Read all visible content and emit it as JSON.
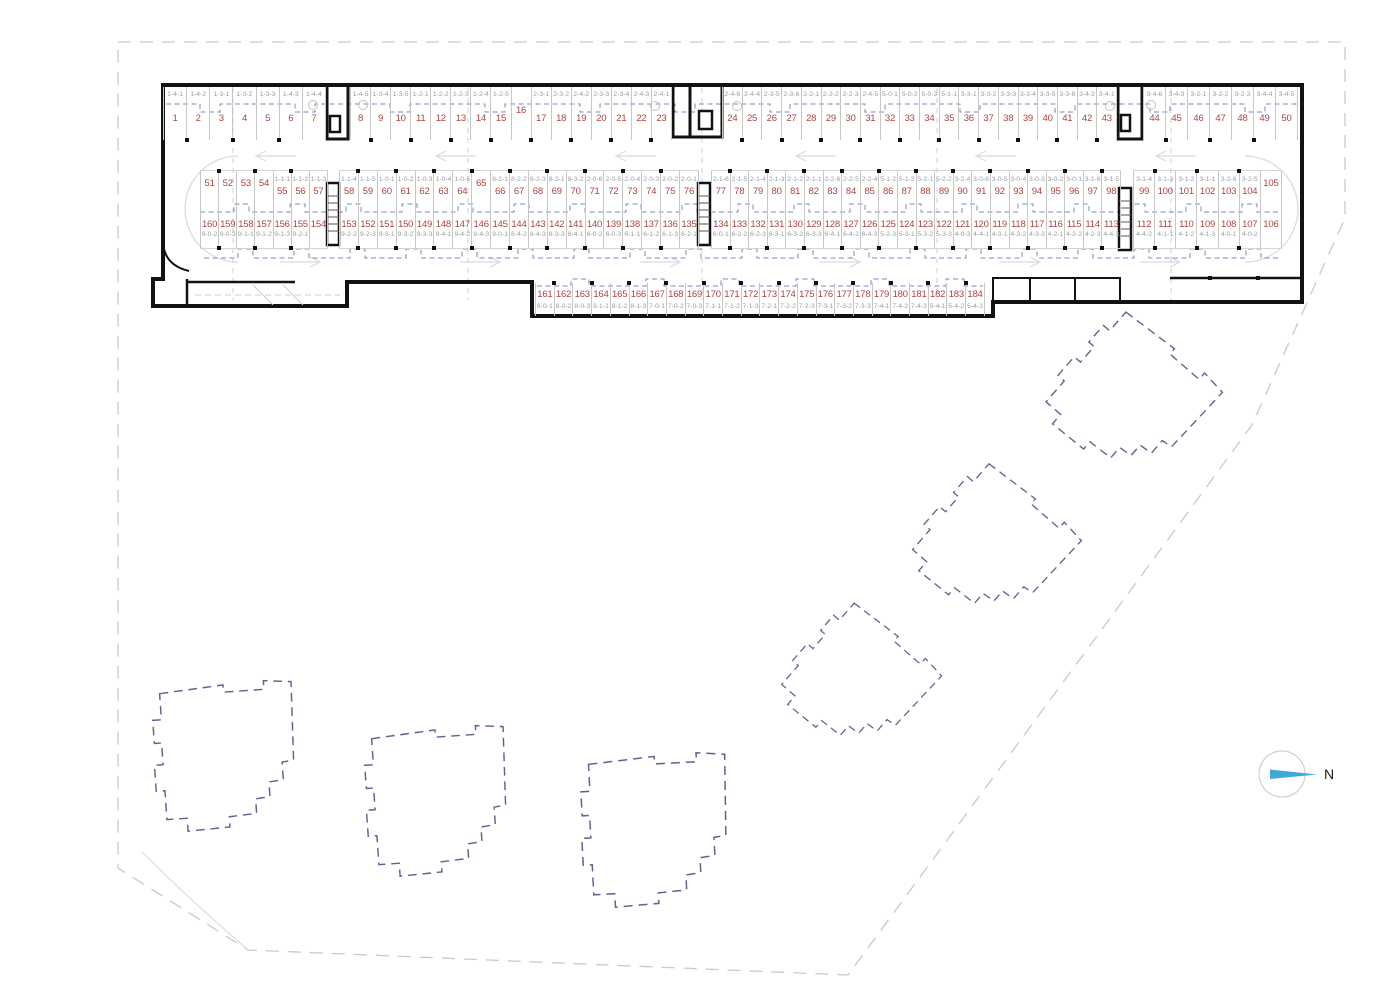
{
  "plan": {
    "north_label": "N",
    "colors": {
      "space_number": "#ac4340",
      "unit_label": "#9c9c9c",
      "building_outline": "#5d6390",
      "north_arrow_blue": "#3fa9dc",
      "walls": "#121212"
    },
    "rows": [
      {
        "id": "top",
        "y": 87,
        "h": 53,
        "label_first": true,
        "tick_side": "bottom",
        "segments": [
          {
            "x": 163,
            "w": 163,
            "spaces": [
              {
                "no": "1",
                "unit": "1-4-1"
              },
              {
                "no": "2",
                "unit": "1-4-2"
              },
              {
                "no": "3",
                "unit": "1-3-1"
              },
              {
                "no": "4",
                "unit": "1-3-2"
              },
              {
                "no": "5",
                "unit": "1-3-3"
              },
              {
                "no": "6",
                "unit": "1-4-3"
              },
              {
                "no": "7",
                "unit": "1-4-4"
              }
            ]
          },
          {
            "x": 350,
            "w": 322,
            "spaces": [
              {
                "no": "8",
                "unit": "1-4-5"
              },
              {
                "no": "9",
                "unit": "1-3-4"
              },
              {
                "no": "10",
                "unit": "1-3-5"
              },
              {
                "no": "11",
                "unit": "1-2-1"
              },
              {
                "no": "12",
                "unit": "1-2-2"
              },
              {
                "no": "13",
                "unit": "1-2-3"
              },
              {
                "no": "14",
                "unit": "1-2-4"
              },
              {
                "no": "15",
                "unit": "1-2-5"
              },
              {
                "no": "16",
                "unit": ""
              },
              {
                "no": "17",
                "unit": "2-3-1"
              },
              {
                "no": "18",
                "unit": "2-3-2"
              },
              {
                "no": "19",
                "unit": "2-4-2"
              },
              {
                "no": "20",
                "unit": "2-3-3"
              },
              {
                "no": "21",
                "unit": "2-3-4"
              },
              {
                "no": "22",
                "unit": "2-4-3"
              },
              {
                "no": "23",
                "unit": "2-4-1"
              }
            ]
          },
          {
            "x": 722,
            "w": 395,
            "spaces": [
              {
                "no": "24",
                "unit": "2-4-6"
              },
              {
                "no": "25",
                "unit": "2-4-4"
              },
              {
                "no": "26",
                "unit": "2-3-5"
              },
              {
                "no": "27",
                "unit": "2-3-6"
              },
              {
                "no": "28",
                "unit": "2-2-1"
              },
              {
                "no": "29",
                "unit": "2-2-2"
              },
              {
                "no": "30",
                "unit": "2-2-3"
              },
              {
                "no": "31",
                "unit": "2-4-5"
              },
              {
                "no": "32",
                "unit": "5-0-1"
              },
              {
                "no": "33",
                "unit": "5-0-2"
              },
              {
                "no": "34",
                "unit": "5-0-3"
              },
              {
                "no": "35",
                "unit": "5-1-1"
              },
              {
                "no": "36",
                "unit": "3-3-1"
              },
              {
                "no": "37",
                "unit": "3-3-2"
              },
              {
                "no": "38",
                "unit": "3-3-3"
              },
              {
                "no": "39",
                "unit": "3-3-4"
              },
              {
                "no": "40",
                "unit": "3-3-5"
              },
              {
                "no": "41",
                "unit": "3-3-6"
              },
              {
                "no": "42",
                "unit": "3-4-2"
              },
              {
                "no": "43",
                "unit": "3-4-1"
              }
            ]
          },
          {
            "x": 1143,
            "w": 155,
            "spaces": [
              {
                "no": "44",
                "unit": "3-4-6"
              },
              {
                "no": "45",
                "unit": "3-4-3"
              },
              {
                "no": "46",
                "unit": "3-2-1"
              },
              {
                "no": "47",
                "unit": "3-2-2"
              },
              {
                "no": "48",
                "unit": "3-2-3"
              },
              {
                "no": "49",
                "unit": "3-4-4"
              },
              {
                "no": "50",
                "unit": "3-4-5"
              }
            ]
          }
        ]
      },
      {
        "id": "midup",
        "y": 170,
        "h": 42,
        "label_first": true,
        "tick_side": "top",
        "segments": [
          {
            "x": 200,
            "w": 128,
            "spaces": [
              {
                "no": "51",
                "unit": ""
              },
              {
                "no": "52",
                "unit": ""
              },
              {
                "no": "53",
                "unit": ""
              },
              {
                "no": "54",
                "unit": ""
              },
              {
                "no": "55",
                "unit": "1-1-1"
              },
              {
                "no": "56",
                "unit": "1-1-2"
              },
              {
                "no": "57",
                "unit": "1-1-3"
              }
            ]
          },
          {
            "x": 339,
            "w": 360,
            "spaces": [
              {
                "no": "58",
                "unit": "1-1-4"
              },
              {
                "no": "59",
                "unit": "1-1-5"
              },
              {
                "no": "60",
                "unit": "1-0-1"
              },
              {
                "no": "61",
                "unit": "1-0-2"
              },
              {
                "no": "62",
                "unit": "1-0-3"
              },
              {
                "no": "63",
                "unit": "1-0-4"
              },
              {
                "no": "64",
                "unit": "1-0-5"
              },
              {
                "no": "65",
                "unit": ""
              },
              {
                "no": "66",
                "unit": "8-2-1"
              },
              {
                "no": "67",
                "unit": "8-2-2"
              },
              {
                "no": "68",
                "unit": "8-2-3"
              },
              {
                "no": "69",
                "unit": "8-3-1"
              },
              {
                "no": "70",
                "unit": "8-3-2"
              },
              {
                "no": "71",
                "unit": "2-0-6"
              },
              {
                "no": "72",
                "unit": "2-0-5"
              },
              {
                "no": "73",
                "unit": "2-0-4"
              },
              {
                "no": "74",
                "unit": "2-0-3"
              },
              {
                "no": "75",
                "unit": "2-0-2"
              },
              {
                "no": "76",
                "unit": "2-0-1"
              }
            ]
          },
          {
            "x": 711,
            "w": 410,
            "spaces": [
              {
                "no": "77",
                "unit": "2-1-6"
              },
              {
                "no": "78",
                "unit": "2-1-5"
              },
              {
                "no": "79",
                "unit": "2-1-4"
              },
              {
                "no": "80",
                "unit": "2-1-3"
              },
              {
                "no": "81",
                "unit": "2-1-2"
              },
              {
                "no": "82",
                "unit": "2-1-1"
              },
              {
                "no": "83",
                "unit": "2-2-6"
              },
              {
                "no": "84",
                "unit": "2-2-5"
              },
              {
                "no": "85",
                "unit": "2-2-4"
              },
              {
                "no": "86",
                "unit": "5-1-2"
              },
              {
                "no": "87",
                "unit": "5-1-3"
              },
              {
                "no": "88",
                "unit": "5-2-1"
              },
              {
                "no": "89",
                "unit": "5-2-2"
              },
              {
                "no": "90",
                "unit": "3-2-4"
              },
              {
                "no": "91",
                "unit": "3-0-6"
              },
              {
                "no": "92",
                "unit": "3-0-5"
              },
              {
                "no": "93",
                "unit": "3-0-4"
              },
              {
                "no": "94",
                "unit": "3-0-3"
              },
              {
                "no": "95",
                "unit": "3-0-2"
              },
              {
                "no": "96",
                "unit": "3-0-1"
              },
              {
                "no": "97",
                "unit": "3-1-6"
              },
              {
                "no": "98",
                "unit": "3-1-5"
              }
            ]
          },
          {
            "x": 1133,
            "w": 149,
            "spaces": [
              {
                "no": "99",
                "unit": "3-1-4"
              },
              {
                "no": "100",
                "unit": "3-1-3"
              },
              {
                "no": "101",
                "unit": "3-1-2"
              },
              {
                "no": "102",
                "unit": "3-1-1"
              },
              {
                "no": "103",
                "unit": "3-2-6"
              },
              {
                "no": "104",
                "unit": "3-2-5"
              },
              {
                "no": "105",
                "unit": ""
              }
            ]
          }
        ]
      },
      {
        "id": "middown",
        "y": 212,
        "h": 36,
        "label_first": false,
        "tick_side": "bottom",
        "segments": [
          {
            "x": 200,
            "w": 128,
            "spaces": [
              {
                "no": "160",
                "unit": "9-0-2"
              },
              {
                "no": "159",
                "unit": "9-0-3"
              },
              {
                "no": "158",
                "unit": "9-1-1"
              },
              {
                "no": "157",
                "unit": "9-1-2"
              },
              {
                "no": "156",
                "unit": "9-1-3"
              },
              {
                "no": "155",
                "unit": "9-2-1"
              },
              {
                "no": "154",
                "unit": ""
              }
            ]
          },
          {
            "x": 339,
            "w": 360,
            "spaces": [
              {
                "no": "153",
                "unit": "9-2-2"
              },
              {
                "no": "152",
                "unit": "9-2-3"
              },
              {
                "no": "151",
                "unit": "9-3-1"
              },
              {
                "no": "150",
                "unit": "9-3-2"
              },
              {
                "no": "149",
                "unit": "9-3-3"
              },
              {
                "no": "148",
                "unit": "9-4-1"
              },
              {
                "no": "147",
                "unit": "9-4-2"
              },
              {
                "no": "146",
                "unit": "9-4-3"
              },
              {
                "no": "145",
                "unit": "9-0-1"
              },
              {
                "no": "144",
                "unit": "8-4-2"
              },
              {
                "no": "143",
                "unit": "8-4-3"
              },
              {
                "no": "142",
                "unit": "8-3-3"
              },
              {
                "no": "141",
                "unit": "8-4-1"
              },
              {
                "no": "140",
                "unit": "6-0-2"
              },
              {
                "no": "139",
                "unit": "6-0-3"
              },
              {
                "no": "138",
                "unit": "6-1-1"
              },
              {
                "no": "137",
                "unit": "6-1-2"
              },
              {
                "no": "136",
                "unit": "6-1-3"
              },
              {
                "no": "135",
                "unit": "6-2-1"
              }
            ]
          },
          {
            "x": 711,
            "w": 410,
            "spaces": [
              {
                "no": "134",
                "unit": "6-0-1"
              },
              {
                "no": "133",
                "unit": "6-2-2"
              },
              {
                "no": "132",
                "unit": "6-2-3"
              },
              {
                "no": "131",
                "unit": "6-3-1"
              },
              {
                "no": "130",
                "unit": "6-3-2"
              },
              {
                "no": "129",
                "unit": "6-3-3"
              },
              {
                "no": "128",
                "unit": "6-4-1"
              },
              {
                "no": "127",
                "unit": "6-4-2"
              },
              {
                "no": "126",
                "unit": "6-4-3"
              },
              {
                "no": "125",
                "unit": "5-2-3"
              },
              {
                "no": "124",
                "unit": "5-3-1"
              },
              {
                "no": "123",
                "unit": "5-3-2"
              },
              {
                "no": "122",
                "unit": "5-3-3"
              },
              {
                "no": "121",
                "unit": "4-0-3"
              },
              {
                "no": "120",
                "unit": "4-4-1"
              },
              {
                "no": "119",
                "unit": "4-3-1"
              },
              {
                "no": "118",
                "unit": "4-3-2"
              },
              {
                "no": "117",
                "unit": "4-3-3"
              },
              {
                "no": "116",
                "unit": "4-2-1"
              },
              {
                "no": "115",
                "unit": "4-2-2"
              },
              {
                "no": "114",
                "unit": "4-2-3"
              },
              {
                "no": "113",
                "unit": "4-4-3"
              }
            ]
          },
          {
            "x": 1133,
            "w": 149,
            "spaces": [
              {
                "no": "112",
                "unit": "4-4-2"
              },
              {
                "no": "111",
                "unit": "4-1-1"
              },
              {
                "no": "110",
                "unit": "4-1-2"
              },
              {
                "no": "109",
                "unit": "4-1-3"
              },
              {
                "no": "108",
                "unit": "4-0-1"
              },
              {
                "no": "107",
                "unit": "4-0-2"
              },
              {
                "no": "106",
                "unit": ""
              }
            ]
          }
        ]
      },
      {
        "id": "bottomrow",
        "y": 283,
        "h": 33,
        "label_first": false,
        "tick_side": "top",
        "segments": [
          {
            "x": 535,
            "w": 450,
            "spaces": [
              {
                "no": "161",
                "unit": "8-0-1"
              },
              {
                "no": "162",
                "unit": "8-0-2"
              },
              {
                "no": "163",
                "unit": "8-0-3"
              },
              {
                "no": "164",
                "unit": "8-1-1"
              },
              {
                "no": "165",
                "unit": "8-1-2"
              },
              {
                "no": "166",
                "unit": "8-1-3"
              },
              {
                "no": "167",
                "unit": "7-0-1"
              },
              {
                "no": "168",
                "unit": "7-0-2"
              },
              {
                "no": "169",
                "unit": "7-0-3"
              },
              {
                "no": "170",
                "unit": "7-1-1"
              },
              {
                "no": "171",
                "unit": "7-1-2"
              },
              {
                "no": "172",
                "unit": "7-1-3"
              },
              {
                "no": "173",
                "unit": "7-2-1"
              },
              {
                "no": "174",
                "unit": "7-2-2"
              },
              {
                "no": "175",
                "unit": "7-2-3"
              },
              {
                "no": "176",
                "unit": "7-3-1"
              },
              {
                "no": "177",
                "unit": "7-3-2"
              },
              {
                "no": "178",
                "unit": "7-3-3"
              },
              {
                "no": "179",
                "unit": "7-4-1"
              },
              {
                "no": "180",
                "unit": "7-4-2"
              },
              {
                "no": "181",
                "unit": "7-4-3"
              },
              {
                "no": "182",
                "unit": "5-4-1"
              },
              {
                "no": "183",
                "unit": "5-4-2"
              },
              {
                "no": "184",
                "unit": "5-4-3"
              }
            ]
          }
        ]
      }
    ]
  }
}
